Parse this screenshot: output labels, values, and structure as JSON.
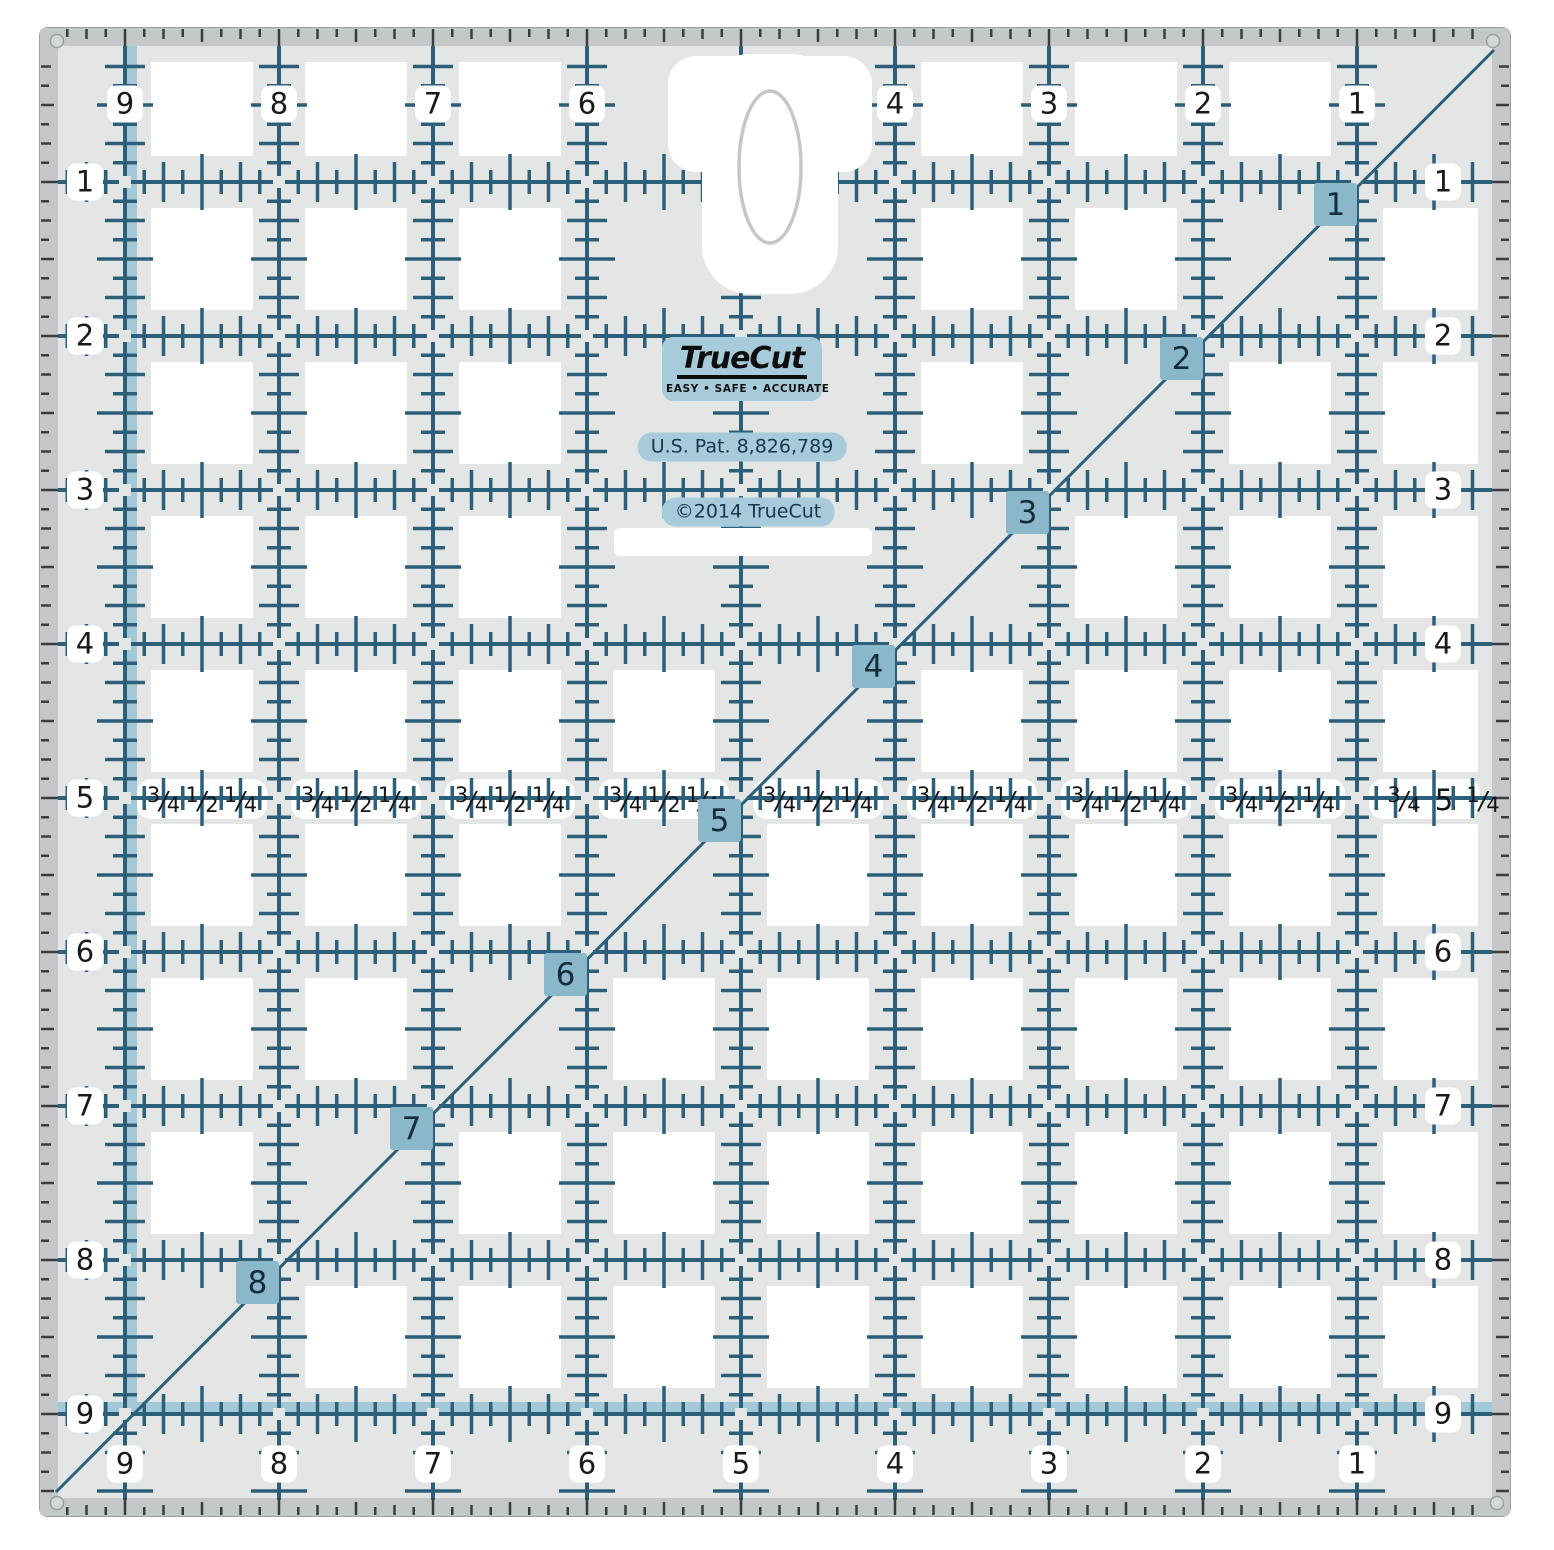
{
  "product": {
    "brand": "TrueCut",
    "tagline": "EASY • SAFE • ACCURATE",
    "patent": "U.S. Pat. 8,826,789",
    "copyright": "©2014 TrueCut"
  },
  "ruler": {
    "top_labels": [
      "9",
      "8",
      "7",
      "6",
      "",
      "4",
      "3",
      "2",
      "1"
    ],
    "bottom_labels": [
      "9",
      "8",
      "7",
      "6",
      "5",
      "4",
      "3",
      "2",
      "1"
    ],
    "left_labels": [
      "1",
      "2",
      "3",
      "4",
      "5",
      "6",
      "7",
      "8",
      "9"
    ],
    "right_labels": [
      "1",
      "2",
      "3",
      "4",
      "",
      "6",
      "7",
      "8",
      "9"
    ],
    "diagonal_labels": [
      "1",
      "2",
      "3",
      "4",
      "5",
      "6",
      "7",
      "8"
    ],
    "fraction_group": [
      "3/4",
      "1/2",
      "1/4"
    ],
    "fraction_group_right": [
      "3/4",
      "5",
      "1/4"
    ]
  },
  "colors": {
    "grid": "#2b5f7a",
    "edge_tick": "#3a3d3e",
    "accent_stripe": "#a3c9d9",
    "diag_square_bg": "#8bb7ca",
    "body": "#e4e6e5",
    "rim": "#c5c8c9",
    "rim_edge": "#9aa0a1",
    "label_pill": "#ffffff",
    "logo_pill_bg": "#a7cbda",
    "brand_ink": "#16384c",
    "hole_ring": "#c4c7c8"
  }
}
